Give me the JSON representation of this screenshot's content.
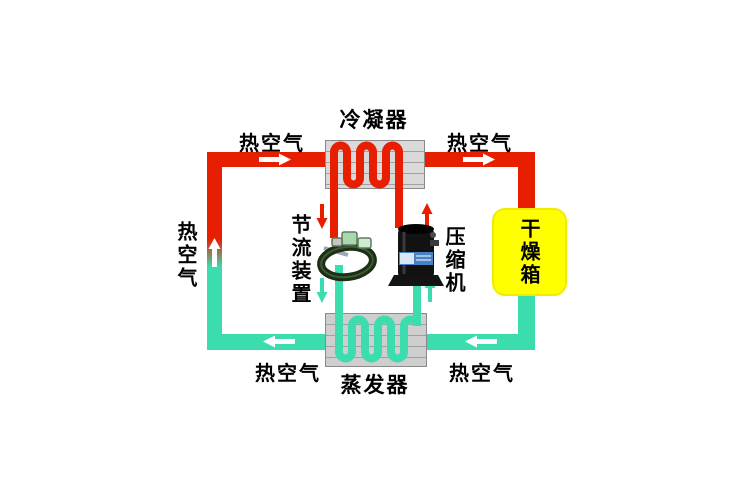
{
  "labels": {
    "condenser": "冷凝器",
    "evaporator": "蒸发器",
    "throttle_device": "节流装置",
    "compressor": "压缩机",
    "drying_box": "干燥箱",
    "hot_air": "热空气"
  },
  "colors": {
    "hot": "#e81e00",
    "cold": "#3bdcae",
    "arrow_white": "#ffffff",
    "dryer_fill": "#ffff00",
    "exchanger_fill": "#d9d9d9"
  }
}
